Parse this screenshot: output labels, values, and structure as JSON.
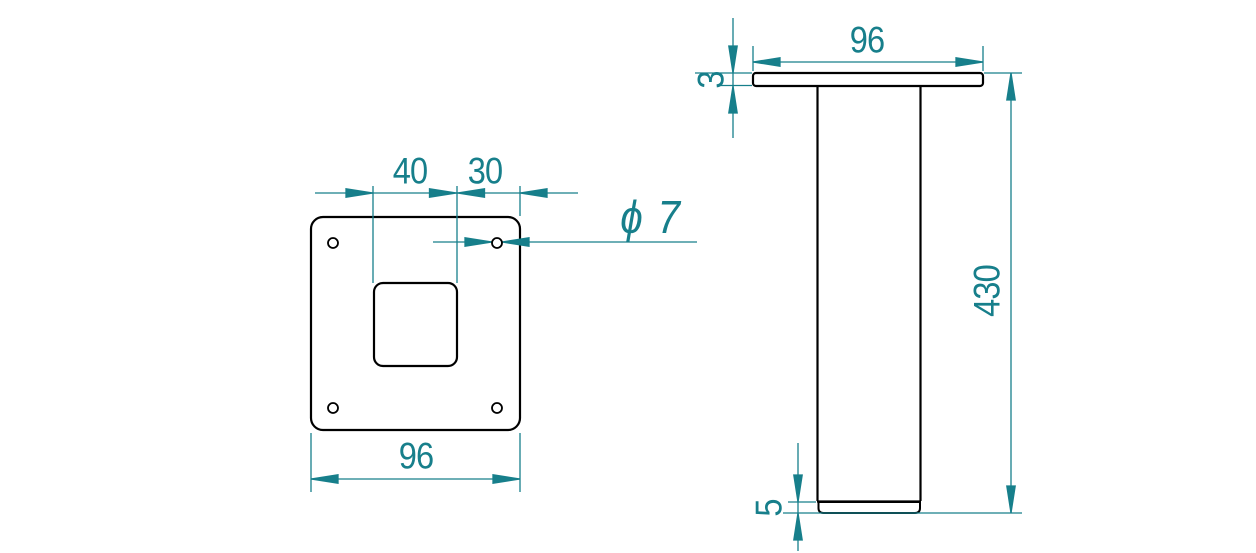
{
  "drawing_title": "furniture-leg-with-mounting-plate",
  "colors": {
    "dimension": "#177f8b",
    "outline": "#000000",
    "background": "#ffffff"
  },
  "top_view": {
    "dim_square_offset": "40",
    "dim_edge_offset": "30",
    "hole_diameter_label": "ϕ 7",
    "dim_plate_width": "96"
  },
  "side_view": {
    "dim_plate_width": "96",
    "dim_plate_thickness": "3",
    "dim_leg_length": "430",
    "dim_foot_height": "5"
  }
}
